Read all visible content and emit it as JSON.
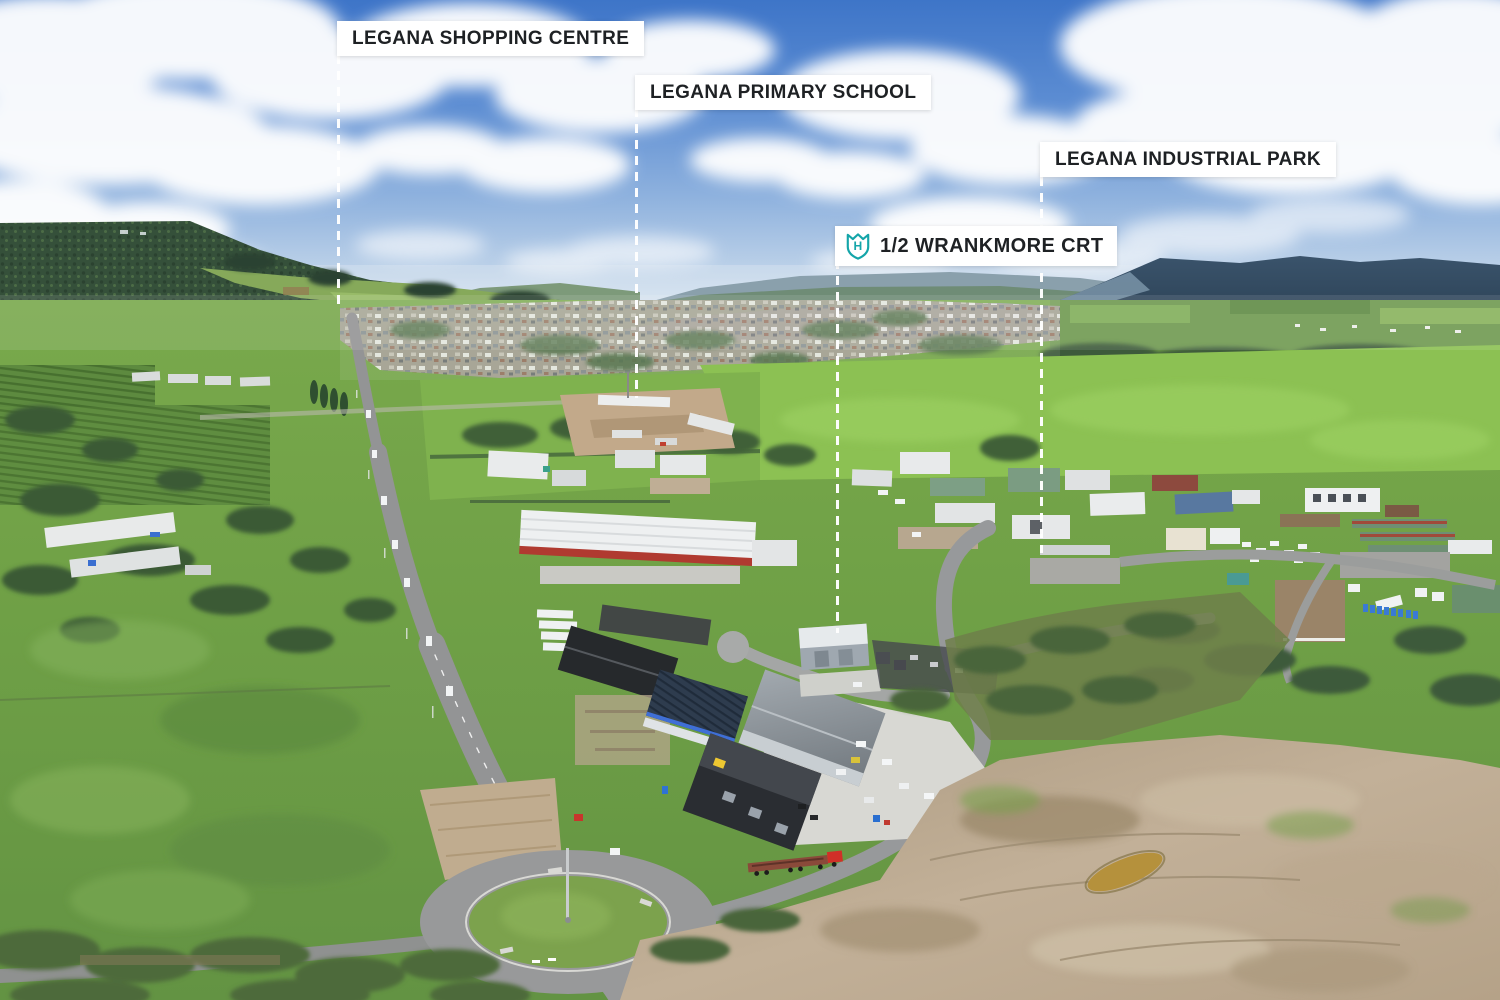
{
  "page": {
    "type": "aerial-property-marketing-photo",
    "description": "Drone aerial view over Legana with location callouts"
  },
  "callouts": [
    {
      "id": "shopping-centre",
      "label": "LEGANA SHOPPING CENTRE"
    },
    {
      "id": "primary-school",
      "label": "LEGANA PRIMARY SCHOOL"
    },
    {
      "id": "industrial-park",
      "label": "LEGANA INDUSTRIAL PARK"
    },
    {
      "id": "property",
      "label": "1/2 WRANKMORE CRT",
      "icon": "shield-h-badge"
    }
  ],
  "colors": {
    "label_background": "#ffffff",
    "label_text": "#1e2124",
    "leader_line": "#ffffff",
    "brand_teal": "#14a5a9"
  }
}
